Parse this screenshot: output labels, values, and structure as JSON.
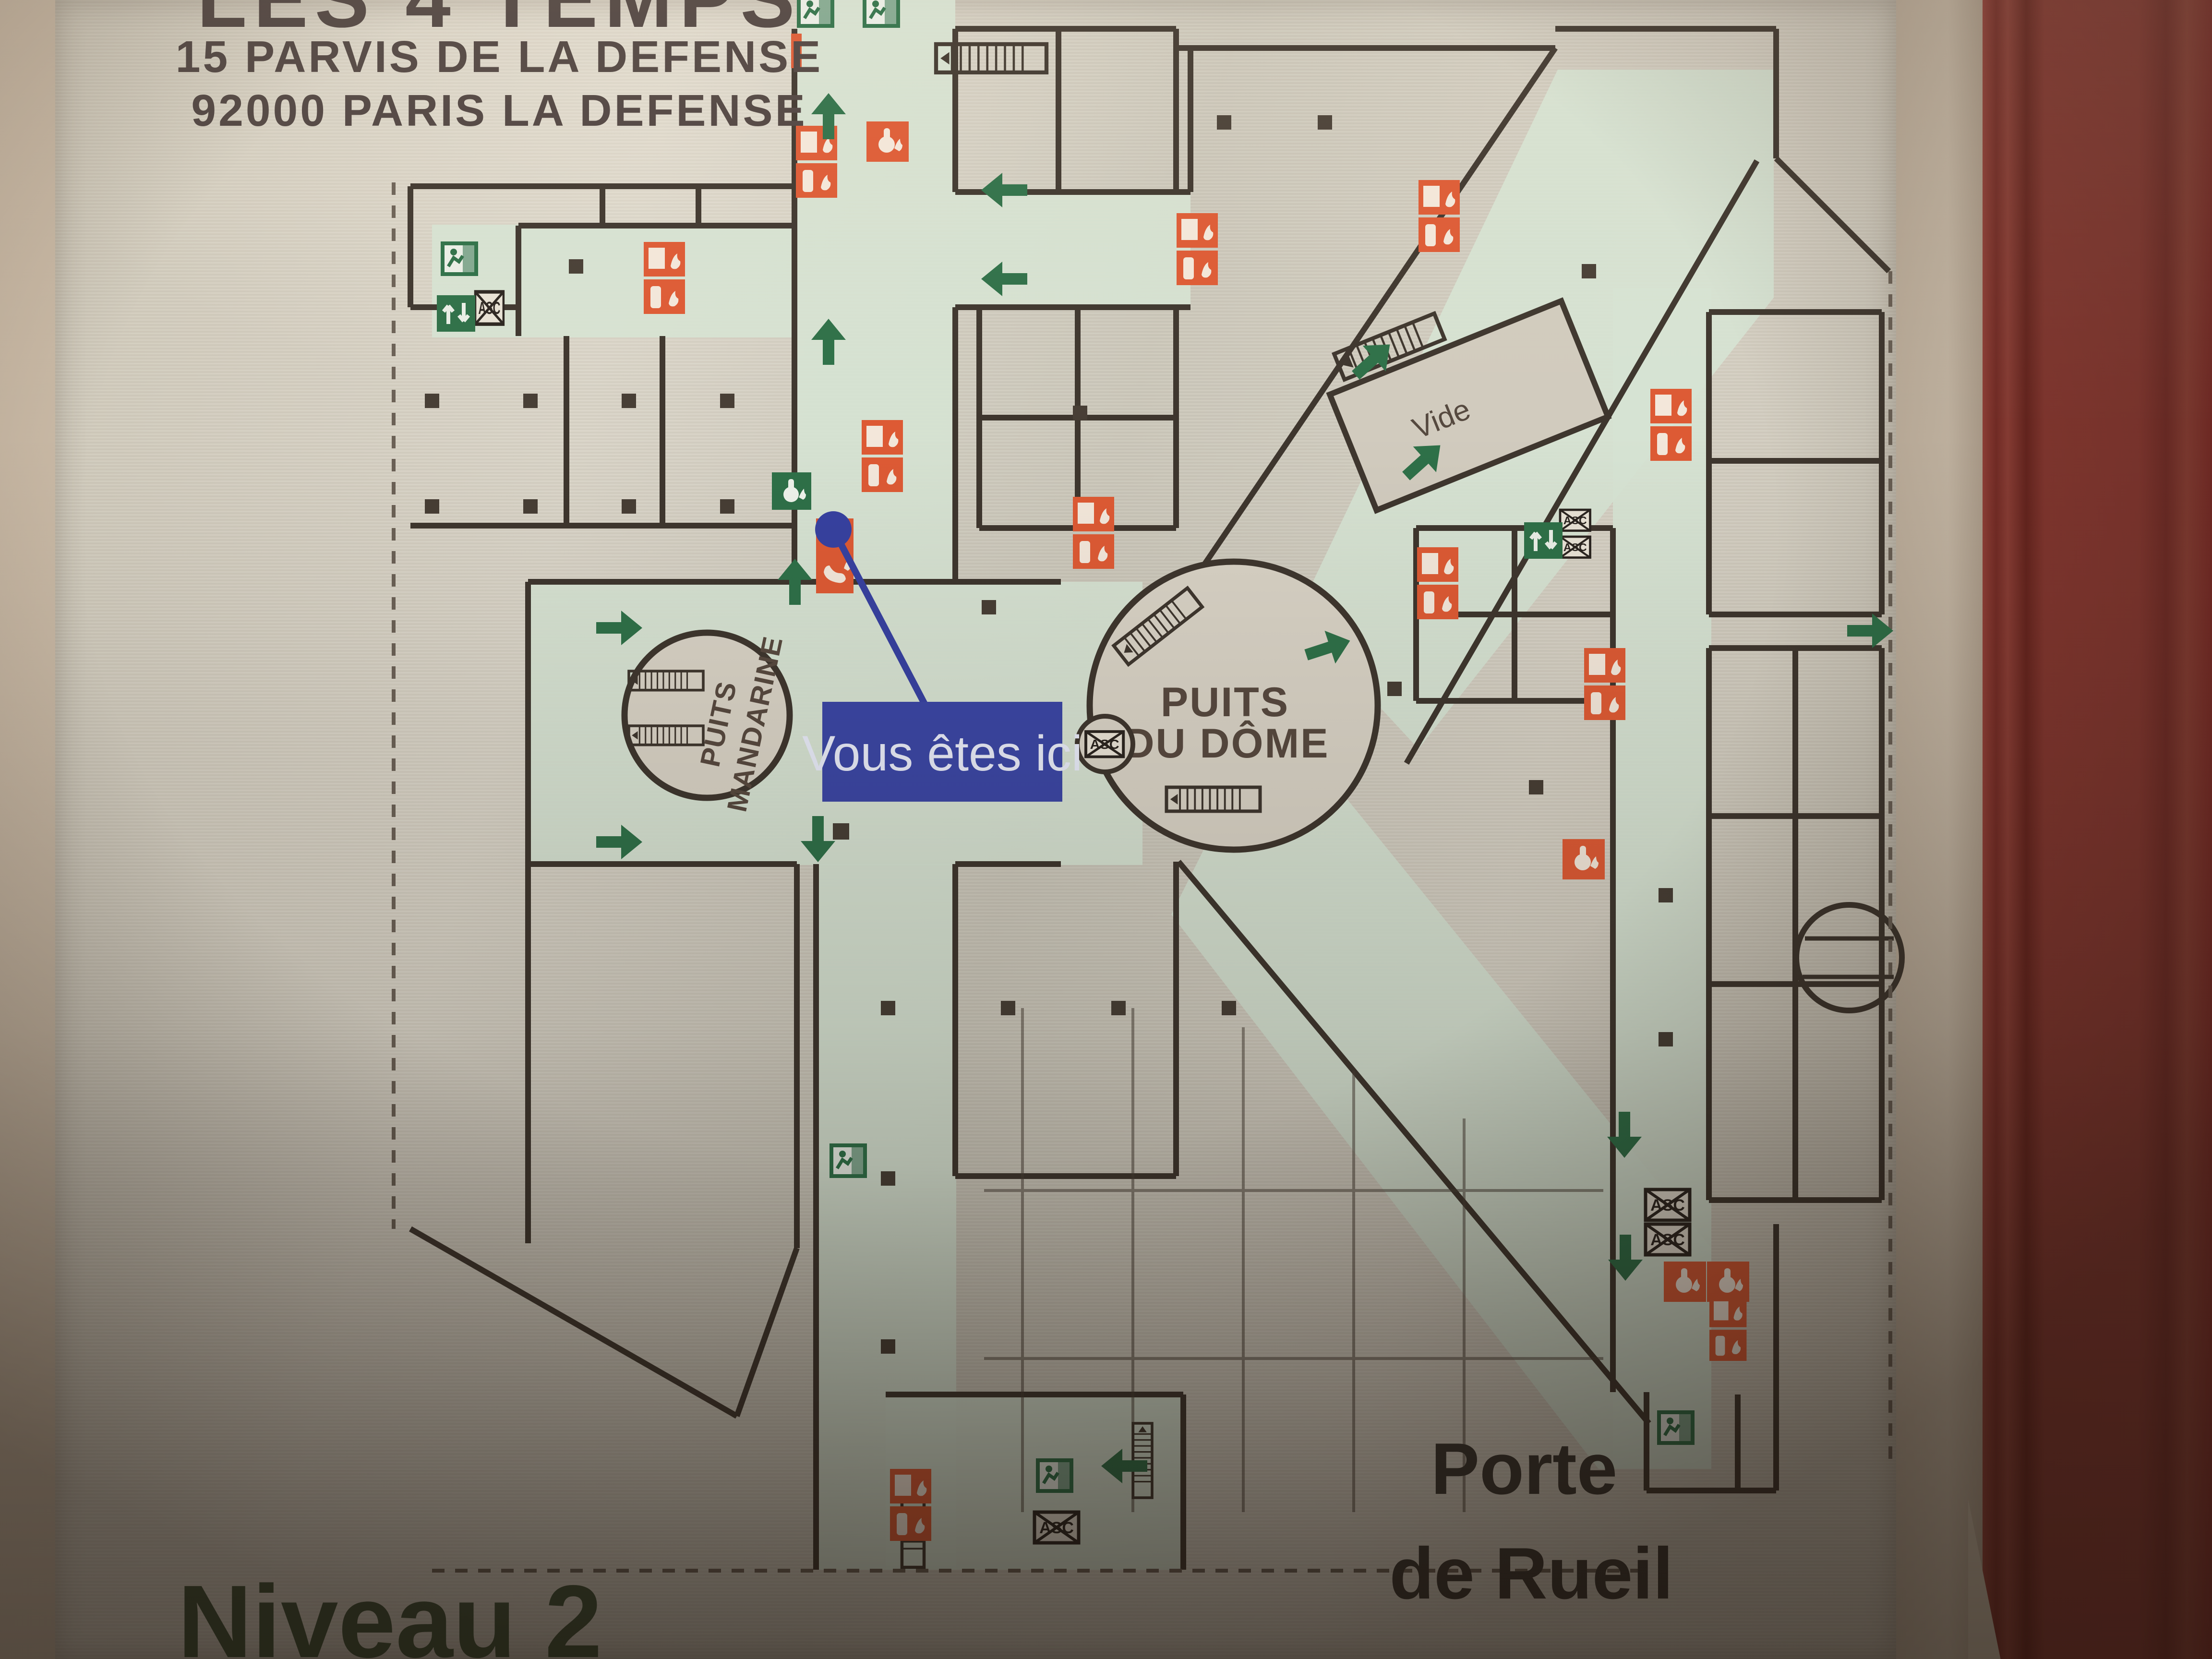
{
  "plaque": {
    "title": "LES 4 TEMPS",
    "address_line1": "15 PARVIS DE LA DEFENSE",
    "address_line2": "92000 PARIS LA DEFENSE",
    "level_label": "Niveau 2"
  },
  "map": {
    "you_are_here_label": "Vous êtes ici",
    "void_label": "Vide",
    "puits_mandarine_line1": "PUITS",
    "puits_mandarine_line2": "MANDARINE",
    "puits_du_dome_line1": "PUITS",
    "puits_du_dome_line2": "DU DÔME",
    "exit_name_line1": "Porte",
    "exit_name_line2": "de Rueil",
    "elevator_abbr": "ASC"
  },
  "colors": {
    "corridor_green": "#d6e3d3",
    "wall_line": "#3e362e",
    "safety_orange": "#dd5a34",
    "exit_green": "#2e7048",
    "you_are_here_blue": "#3b46a4",
    "plaque_metal": "#d2cdc0",
    "cabinet_red": "#8e3b34",
    "level_text_green": "#3e5137"
  }
}
